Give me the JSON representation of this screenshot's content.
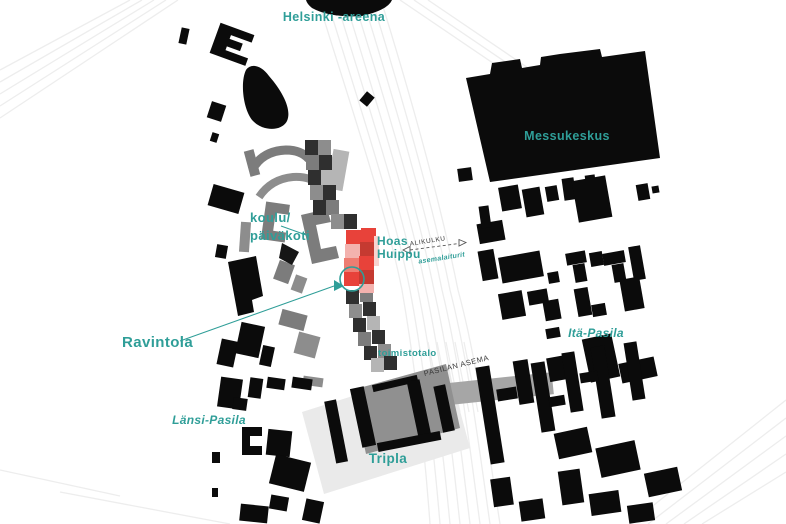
{
  "palette": {
    "teal": "#2f9e98",
    "black": "#0b0b0b",
    "gray_dark": "#2f2f2f",
    "gray": "#7c7c7c",
    "gray_mid": "#8d8d8d",
    "gray_soft": "#b5b5b5",
    "gray_light": "#eaeaea",
    "red": "#e8423a",
    "red_dark": "#c53a31",
    "pink": "#f3b2ae",
    "salmon": "#ee7d72",
    "pink_light": "#f8d3d0"
  },
  "labels": {
    "arena": {
      "text": "Helsinki -areena"
    },
    "messukeskus": {
      "text": "Messukeskus"
    },
    "koulu_line1": {
      "text": "koulu/"
    },
    "koulu_line2": {
      "text": "päiväkoti"
    },
    "hoas_line1": {
      "text": "Hoas"
    },
    "hoas_line2": {
      "text": "Huippu"
    },
    "ravintola": {
      "text": "Ravintola"
    },
    "toimistotalo": {
      "text": "toimistotalo"
    },
    "alikulku": {
      "text": "ALIKULKU"
    },
    "asemalaiturit": {
      "text": "asemalaiturit"
    },
    "pasilan_asema": {
      "text": "PASILAN ASEMA"
    },
    "ita_pasila": {
      "text": "Itä-Pasila"
    },
    "lansi_pasila": {
      "text": "Länsi-Pasila"
    },
    "tripla": {
      "text": "Tripla"
    }
  },
  "hoas_tower": {
    "cell_w": 15,
    "cell_h": 14,
    "cells": [
      {
        "x": 346,
        "y": 230,
        "fill": "red"
      },
      {
        "x": 361,
        "y": 228,
        "fill": "red"
      },
      {
        "x": 345,
        "y": 244,
        "fill": "pink"
      },
      {
        "x": 360,
        "y": 242,
        "fill": "red_dark"
      },
      {
        "x": 344,
        "y": 258,
        "fill": "salmon"
      },
      {
        "x": 359,
        "y": 256,
        "fill": "red"
      },
      {
        "x": 344,
        "y": 272,
        "fill": "red"
      },
      {
        "x": 359,
        "y": 270,
        "fill": "red_dark"
      },
      {
        "x": 374,
        "y": 236,
        "w": 5,
        "h": 30,
        "fill": "pink_light"
      },
      {
        "x": 359,
        "y": 284,
        "w": 15,
        "h": 9,
        "fill": "pink"
      }
    ]
  },
  "strip": {
    "upper": [
      {
        "x": 305,
        "y": 140,
        "fill": "gray_dark"
      },
      {
        "x": 318,
        "y": 140,
        "fill": "gray_mid"
      },
      {
        "x": 306,
        "y": 155,
        "fill": "gray"
      },
      {
        "x": 319,
        "y": 155,
        "fill": "gray_dark"
      },
      {
        "x": 308,
        "y": 170,
        "fill": "gray_dark"
      },
      {
        "x": 321,
        "y": 170,
        "fill": "gray_soft"
      },
      {
        "x": 310,
        "y": 185,
        "fill": "gray_mid"
      },
      {
        "x": 323,
        "y": 185,
        "fill": "gray_dark"
      },
      {
        "x": 313,
        "y": 200,
        "fill": "gray_dark"
      },
      {
        "x": 326,
        "y": 200,
        "fill": "gray"
      },
      {
        "x": 331,
        "y": 214,
        "fill": "gray_mid"
      },
      {
        "x": 344,
        "y": 214,
        "fill": "gray_dark"
      }
    ],
    "lower": [
      {
        "x": 346,
        "y": 290,
        "fill": "gray_dark"
      },
      {
        "x": 360,
        "y": 288,
        "fill": "gray"
      },
      {
        "x": 349,
        "y": 304,
        "fill": "gray_mid"
      },
      {
        "x": 363,
        "y": 302,
        "fill": "gray_dark"
      },
      {
        "x": 353,
        "y": 318,
        "fill": "gray_dark"
      },
      {
        "x": 367,
        "y": 316,
        "fill": "gray_soft"
      },
      {
        "x": 358,
        "y": 332,
        "fill": "gray"
      },
      {
        "x": 372,
        "y": 330,
        "fill": "gray_dark"
      },
      {
        "x": 364,
        "y": 346,
        "fill": "gray_dark"
      },
      {
        "x": 378,
        "y": 344,
        "fill": "gray_mid"
      },
      {
        "x": 371,
        "y": 358,
        "fill": "gray_soft"
      },
      {
        "x": 384,
        "y": 356,
        "fill": "gray_dark"
      }
    ]
  },
  "highlight": {
    "note": "circled restaurant unit of Hoas Huippu tower"
  }
}
